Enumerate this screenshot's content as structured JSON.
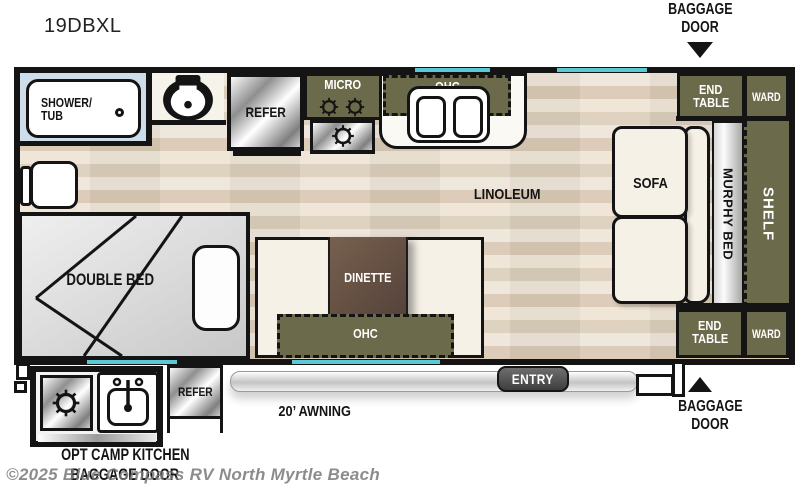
{
  "title": "19DBXL",
  "plan": {
    "bathroom": {
      "shower_line1": "SHOWER/",
      "shower_line2": "TUB"
    },
    "kitchen": {
      "refer": "REFER",
      "micro": "MICRO",
      "ohc": "OHC"
    },
    "living": {
      "linoleum": "LINOLEUM",
      "sofa": "SOFA",
      "murphy_bed": "MURPHY BED",
      "shelf": "SHELF",
      "end_table_line1": "END",
      "end_table_line2": "TABLE",
      "ward": "WARD"
    },
    "dinette": {
      "table": "DINETTE",
      "ohc": "OHC"
    },
    "bedroom": {
      "double_bed": "DOUBLE BED"
    },
    "exterior": {
      "entry": "ENTRY",
      "awning": "20’ AWNING",
      "opt_camp_kitchen": "OPT CAMP KITCHEN",
      "baggage_line1": "BAGGAGE",
      "baggage_line2": "DOOR",
      "baggage_door_full": "BAGGAGE DOOR",
      "camp_refer": "REFER"
    }
  },
  "watermark": "©2025 Blue Compass RV North Myrtle Beach",
  "colors": {
    "olive": "#6b6a4a",
    "window_teal": "#5cc8d4",
    "wall": "#141414",
    "floor": "#e8ddcc",
    "bath_blue": "#cdddea",
    "cream": "#f6f1e7",
    "table_brown": "#64503f"
  }
}
